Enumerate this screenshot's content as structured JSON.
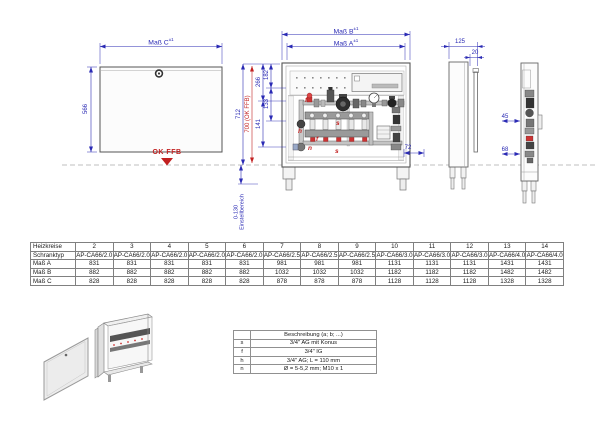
{
  "drawing": {
    "front_view": {
      "dim_width": {
        "label": "Maß C",
        "tolerance": "±1"
      },
      "dim_height": "566",
      "floor_label": "OK FFB"
    },
    "open_view": {
      "dim_outer_width": {
        "label": "Maß B",
        "tolerance": "±1"
      },
      "dim_inner_width": {
        "label": "Maß A",
        "tolerance": "±1"
      },
      "dim_height_total": "712",
      "dim_height_floor": "700 (OK FFB)",
      "dim_266": "266",
      "dim_182": "182",
      "dim_133": "133",
      "dim_141": "141",
      "dim_72": "72",
      "adjust_range": "0-130",
      "adjust_label": "Einstellbereich",
      "component_labels": [
        "f",
        "s",
        "h",
        "f",
        "n",
        "s"
      ]
    },
    "side_view": {
      "dim_depth": "125",
      "dim_door": "20"
    },
    "section_view": {
      "dim_45": "45",
      "dim_68": "68"
    }
  },
  "size_table": {
    "rows": [
      {
        "label": "Heizkreise",
        "values": [
          "2",
          "3",
          "4",
          "5",
          "6",
          "7",
          "8",
          "9",
          "10",
          "11",
          "12",
          "13",
          "14"
        ]
      },
      {
        "label": "Schranktyp",
        "values": [
          "AP-CA66/2.0",
          "AP-CA66/2.0",
          "AP-CA66/2.0",
          "AP-CA66/2.0",
          "AP-CA66/2.0",
          "AP-CA66/2.5",
          "AP-CA66/2.5",
          "AP-CA66/2.5",
          "AP-CA66/3.0",
          "AP-CA66/3.0",
          "AP-CA66/3.0",
          "AP-CA66/4.0",
          "AP-CA66/4.0"
        ]
      },
      {
        "label": "Maß A",
        "values": [
          "831",
          "831",
          "831",
          "831",
          "831",
          "981",
          "981",
          "981",
          "1131",
          "1131",
          "1131",
          "1431",
          "1431"
        ]
      },
      {
        "label": "Maß B",
        "values": [
          "882",
          "882",
          "882",
          "882",
          "882",
          "1032",
          "1032",
          "1032",
          "1182",
          "1182",
          "1182",
          "1482",
          "1482"
        ]
      },
      {
        "label": "Maß C",
        "values": [
          "828",
          "828",
          "828",
          "828",
          "828",
          "878",
          "878",
          "878",
          "1128",
          "1128",
          "1128",
          "1328",
          "1328"
        ]
      }
    ]
  },
  "legend": {
    "title": "Beschreibung (a; b; ...)",
    "rows": [
      {
        "key": "s",
        "desc": "3/4\" AG mit Konus"
      },
      {
        "key": "f",
        "desc": "3/4\" IG"
      },
      {
        "key": "h",
        "desc": "3/4\" AG; L = 110 mm"
      },
      {
        "key": "n",
        "desc": "Ø = 5-5,2 mm; M10 x 1"
      }
    ]
  },
  "colors": {
    "dimension": "#2a2ab4",
    "accent_red": "#c22020",
    "line": "#555555"
  }
}
